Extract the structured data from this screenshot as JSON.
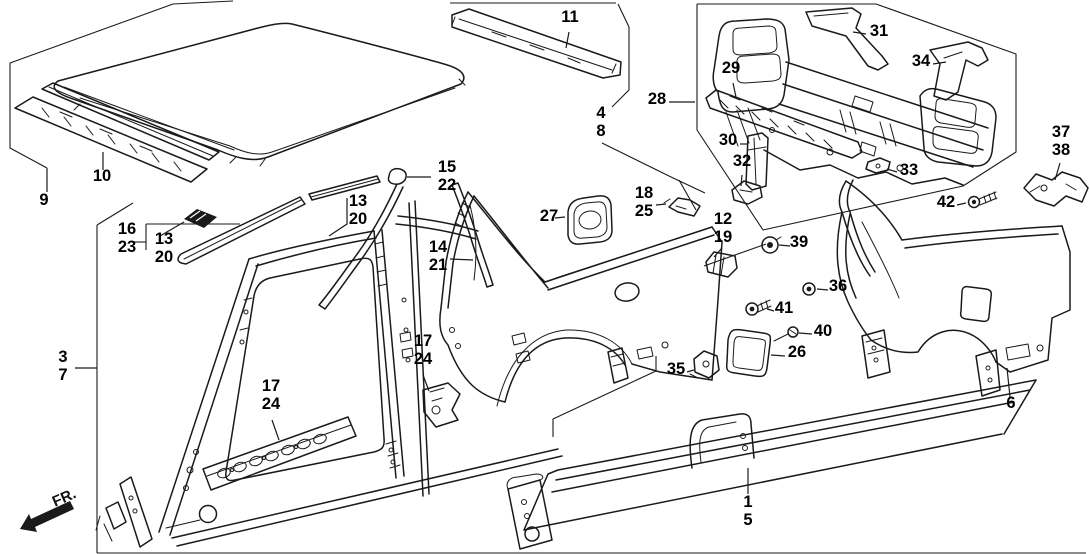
{
  "figure": {
    "width": 1090,
    "height": 554,
    "background": "#ffffff",
    "line_color": "#1a1a1a",
    "label_color": "#000000",
    "type": "exploded-parts-diagram"
  },
  "direction_indicator": {
    "label": "FR."
  },
  "callouts": [
    {
      "labels": [
        "9"
      ],
      "x": 44,
      "y": 205,
      "leader": [
        [
          47,
          168
        ],
        [
          47,
          192
        ]
      ]
    },
    {
      "labels": [
        "10"
      ],
      "x": 102,
      "y": 181,
      "leader": [
        [
          103,
          152
        ],
        [
          103,
          170
        ]
      ]
    },
    {
      "labels": [
        "11"
      ],
      "x": 570,
      "y": 22,
      "leader": [
        [
          566,
          48
        ],
        [
          569,
          32
        ]
      ]
    },
    {
      "labels": [
        "4",
        "8"
      ],
      "x": 601,
      "y": 118
    },
    {
      "labels": [
        "28"
      ],
      "x": 657,
      "y": 104,
      "leader": [
        [
          669,
          102
        ],
        [
          695,
          102
        ]
      ]
    },
    {
      "labels": [
        "29"
      ],
      "x": 731,
      "y": 73,
      "leader": [
        [
          733,
          83
        ],
        [
          736,
          97
        ]
      ]
    },
    {
      "labels": [
        "31"
      ],
      "x": 879,
      "y": 36,
      "leader": [
        [
          866,
          34
        ],
        [
          853,
          32
        ]
      ]
    },
    {
      "labels": [
        "34"
      ],
      "x": 921,
      "y": 66,
      "leader": [
        [
          933,
          64
        ],
        [
          946,
          62
        ]
      ]
    },
    {
      "labels": [
        "30"
      ],
      "x": 728,
      "y": 145,
      "leader": [
        [
          740,
          144
        ],
        [
          747,
          144
        ]
      ]
    },
    {
      "labels": [
        "32"
      ],
      "x": 742,
      "y": 166,
      "leader": [
        [
          742,
          175
        ],
        [
          741,
          186
        ]
      ]
    },
    {
      "labels": [
        "33"
      ],
      "x": 909,
      "y": 175,
      "leader": [
        [
          897,
          172
        ],
        [
          887,
          169
        ]
      ]
    },
    {
      "labels": [
        "37",
        "38"
      ],
      "x": 1061,
      "y": 137,
      "leader": [
        [
          1060,
          163
        ],
        [
          1055,
          180
        ]
      ]
    },
    {
      "labels": [
        "42"
      ],
      "x": 946,
      "y": 207,
      "leader": [
        [
          957,
          205
        ],
        [
          966,
          203
        ]
      ]
    },
    {
      "labels": [
        "15",
        "22"
      ],
      "x": 447,
      "y": 172,
      "leader": [
        [
          431,
          177
        ],
        [
          407,
          177
        ]
      ]
    },
    {
      "labels": [
        "13",
        "20"
      ],
      "x": 358,
      "y": 206,
      "leader": [
        [
          347,
          198
        ],
        [
          347,
          224
        ],
        [
          329,
          236
        ]
      ]
    },
    {
      "labels": [
        "16",
        "23"
      ],
      "x": 127,
      "y": 234
    },
    {
      "labels": [
        "13",
        "20"
      ],
      "x": 164,
      "y": 244
    },
    {
      "labels": [
        "14",
        "21"
      ],
      "x": 438,
      "y": 252,
      "leader": [
        [
          450,
          259
        ],
        [
          473,
          260
        ]
      ]
    },
    {
      "labels": [
        "27"
      ],
      "x": 549,
      "y": 221,
      "leader": [
        [
          555,
          218
        ],
        [
          565,
          217
        ]
      ]
    },
    {
      "labels": [
        "18",
        "25"
      ],
      "x": 644,
      "y": 198,
      "leader": [
        [
          656,
          205
        ],
        [
          666,
          204
        ]
      ]
    },
    {
      "labels": [
        "12",
        "19"
      ],
      "x": 723,
      "y": 224,
      "leader": [
        [
          722,
          248
        ],
        [
          714,
          257
        ]
      ]
    },
    {
      "labels": [
        "39"
      ],
      "x": 799,
      "y": 247,
      "leader": [
        [
          790,
          246
        ],
        [
          779,
          245
        ]
      ]
    },
    {
      "labels": [
        "36"
      ],
      "x": 838,
      "y": 291,
      "leader": [
        [
          828,
          290
        ],
        [
          817,
          289
        ]
      ]
    },
    {
      "labels": [
        "41"
      ],
      "x": 784,
      "y": 313,
      "leader": [
        [
          774,
          311
        ],
        [
          767,
          309
        ]
      ]
    },
    {
      "labels": [
        "40"
      ],
      "x": 823,
      "y": 336,
      "leader": [
        [
          812,
          334
        ],
        [
          799,
          333
        ]
      ]
    },
    {
      "labels": [
        "26"
      ],
      "x": 797,
      "y": 357,
      "leader": [
        [
          785,
          356
        ],
        [
          771,
          355
        ]
      ]
    },
    {
      "labels": [
        "35"
      ],
      "x": 676,
      "y": 374,
      "leader": [
        [
          687,
          372
        ],
        [
          694,
          370
        ]
      ]
    },
    {
      "labels": [
        "6"
      ],
      "x": 1011,
      "y": 408,
      "leader": [
        [
          1010,
          397
        ],
        [
          1007,
          368
        ]
      ]
    },
    {
      "labels": [
        "1",
        "5"
      ],
      "x": 748,
      "y": 507,
      "leader": [
        [
          748,
          494
        ],
        [
          748,
          468
        ]
      ]
    },
    {
      "labels": [
        "17",
        "24"
      ],
      "x": 271,
      "y": 391,
      "leader": [
        [
          272,
          420
        ],
        [
          279,
          440
        ]
      ]
    },
    {
      "labels": [
        "17",
        "24"
      ],
      "x": 423,
      "y": 346,
      "leader": [
        [
          423,
          375
        ],
        [
          429,
          391
        ]
      ]
    },
    {
      "labels": [
        "3",
        "7"
      ],
      "x": 63,
      "y": 362,
      "leader": [
        [
          75,
          368
        ],
        [
          97,
          368
        ]
      ]
    }
  ],
  "boundary_lines": [
    [
      [
        233,
        1
      ],
      [
        173,
        4
      ],
      [
        10,
        63
      ],
      [
        10,
        148
      ],
      [
        47,
        168
      ]
    ],
    [
      [
        450,
        3
      ],
      [
        616,
        3
      ]
    ],
    [
      [
        618,
        4
      ],
      [
        629,
        27
      ],
      [
        629,
        90
      ],
      [
        612,
        107
      ]
    ],
    [
      [
        697,
        4
      ],
      [
        876,
        4
      ],
      [
        1016,
        54
      ],
      [
        1016,
        152
      ],
      [
        963,
        186
      ],
      [
        763,
        230
      ],
      [
        697,
        130
      ],
      [
        697,
        4
      ]
    ],
    [
      [
        602,
        143
      ],
      [
        671,
        177
      ],
      [
        705,
        193
      ]
    ],
    [
      [
        97,
        225
      ],
      [
        133,
        203
      ]
    ],
    [
      [
        97,
        225
      ],
      [
        97,
        553
      ]
    ],
    [
      [
        97,
        553
      ],
      [
        1086,
        553
      ]
    ],
    [
      [
        146,
        224
      ],
      [
        146,
        250
      ]
    ],
    [
      [
        146,
        224
      ],
      [
        240,
        224
      ]
    ],
    [
      [
        134,
        242
      ],
      [
        146,
        242
      ]
    ],
    [
      [
        160,
        236
      ],
      [
        184,
        222
      ]
    ],
    [
      [
        679,
        180
      ],
      [
        696,
        210
      ]
    ],
    [
      [
        704,
        266
      ],
      [
        766,
        244
      ]
    ],
    [
      [
        553,
        437
      ],
      [
        553,
        419
      ],
      [
        656,
        371
      ],
      [
        656,
        356
      ]
    ]
  ]
}
